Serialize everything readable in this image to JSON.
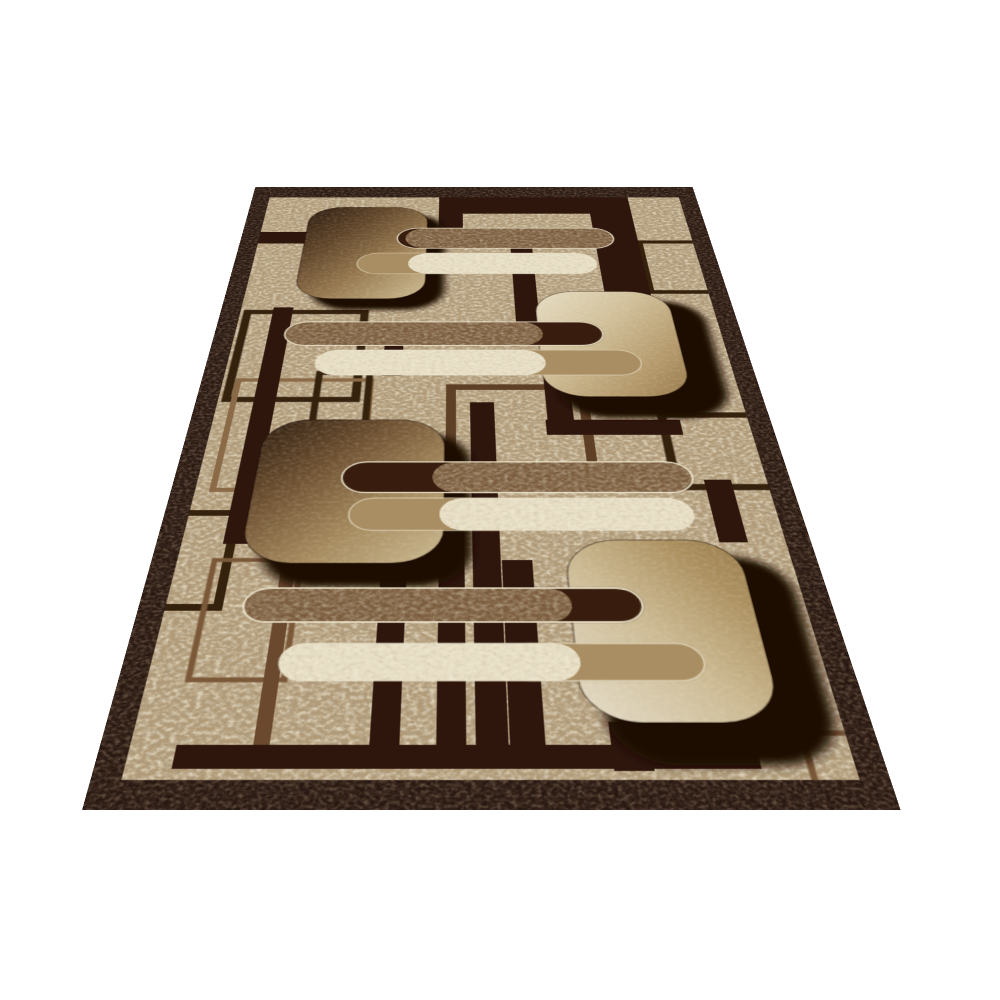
{
  "page": {
    "background_color": "#ffffff"
  },
  "rug": {
    "border_color": "#261711",
    "field_base": "#b09a77",
    "bar_dark": "#2d190e",
    "bar_medium": "#6b4a2e",
    "outline_dark": "#35200f",
    "outline_medium": "#7a5838",
    "outline_medium_dark": "#5d4026",
    "outline_light": "#8a6a46",
    "shadow": "#1c0c04",
    "capsule_dark": "#371e0c",
    "capsule_tan": "#a98e63",
    "pill_brown": "#7b5c3d",
    "pill_cream": "#e8dfc6",
    "pill_outline": "#efe7d0",
    "sq1_grad": [
      "#2b1a0e",
      "#5d4227",
      "#97794f",
      "#c9b68c"
    ],
    "sq2_grad": [
      "#e8dfc6",
      "#d3c29c",
      "#b59a6c",
      "#97794a"
    ],
    "sq3_grad": [
      "#2e1c0f",
      "#6b4e2f",
      "#a68a5e",
      "#c6b38a"
    ],
    "sq4_grad": [
      "#e6deca",
      "#cdbb94",
      "#ab8f5e",
      "#9a7d4e"
    ]
  }
}
